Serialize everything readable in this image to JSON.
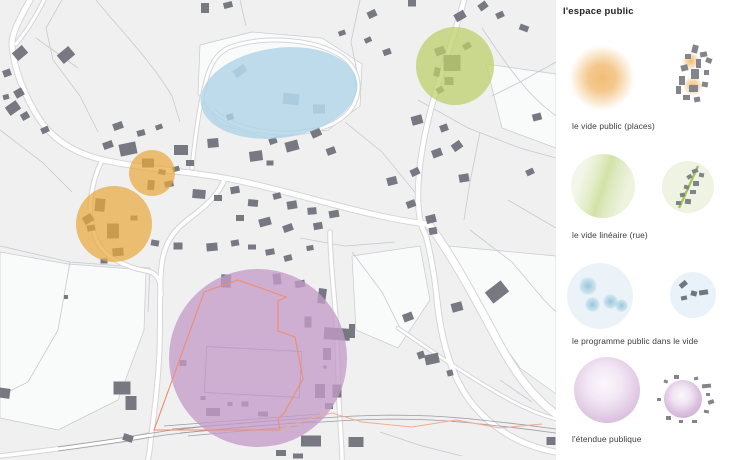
{
  "title": "l'espace public",
  "legend": {
    "items": [
      {
        "label": "le vide public (places)",
        "color": "#eeb05a",
        "symbol": "orange-glow-blob"
      },
      {
        "label": "le vide linéaire (rue)",
        "color": "#c6d77f",
        "symbol": "green-linear-gradient-circle"
      },
      {
        "label": "le programme public dans le vide",
        "color": "#bfdcec",
        "symbol": "blue-circle-with-dots"
      },
      {
        "label": "l'étendue publique",
        "color": "#cdaad2",
        "symbol": "purple-sphere-circle"
      }
    ]
  },
  "map": {
    "background": "#f0f0f1",
    "field_color": "#fafbfb",
    "parcel_line_color": "#c9c9cf",
    "road_casing": "#d5d5d9",
    "road_color": "#ffffff",
    "railway_color": "#9b9ba3",
    "building_color": "#787882",
    "building_light": "#9aadbd",
    "boundary_color": "#ef8e70",
    "boundary_ext_color": "#f2ab8e",
    "overlays": [
      {
        "shape": "ellipse",
        "cx": 279,
        "cy": 93,
        "rx": 79,
        "ry": 45,
        "rot": -8,
        "fill": "#aed3e6",
        "opacity": 0.8,
        "name": "blue-ellipse-overlay"
      },
      {
        "shape": "circle",
        "cx": 455,
        "cy": 66,
        "rx": 39,
        "ry": 39,
        "rot": 0,
        "fill": "#bcd06a",
        "opacity": 0.75,
        "name": "green-circle-overlay"
      },
      {
        "shape": "circle",
        "cx": 152,
        "cy": 173,
        "rx": 23,
        "ry": 23,
        "rot": 0,
        "fill": "#e8a93f",
        "opacity": 0.72,
        "name": "orange-small-overlay"
      },
      {
        "shape": "circle",
        "cx": 114,
        "cy": 224,
        "rx": 38,
        "ry": 38,
        "rot": 0,
        "fill": "#e8a93f",
        "opacity": 0.72,
        "name": "orange-large-overlay"
      },
      {
        "shape": "circle",
        "cx": 258,
        "cy": 358,
        "rx": 89,
        "ry": 89,
        "rot": 0,
        "fill": "#c49bc8",
        "opacity": 0.78,
        "name": "purple-circle-overlay"
      }
    ],
    "fields": [
      "M 200,45 L 252,32 L 322,38 L 362,64 L 360,106 L 328,130 L 268,138 L 220,124 L 198,94 Z",
      "M 448,246 L 556,256 L 556,394 L 520,368 L 472,300 Z",
      "M 0,252 L 68,264 L 146,270 L 144,330 L 118,400 L 58,430 L 0,418 Z",
      "M 352,256 L 420,246 L 430,300 L 398,348 L 356,330 Z",
      "M 486,64 L 556,74 L 556,148 L 502,128 Z"
    ],
    "parcels": [
      "M 62,0 L 46,28 L 53,60 L 80,96 L 98,132",
      "M 96,0 C 122,32 152,62 172,96 L 180,122",
      "M 360,0 L 351,42 L 359,82",
      "M 482,28 C 502,58 522,88 546,108 L 556,116",
      "M 418,100 L 468,128 L 520,148 L 556,158",
      "M 0,130 L 42,162 L 72,192",
      "M 0,246 L 70,262 L 150,268",
      "M 70,262 L 58,330 L 28,382 L 0,396",
      "M 150,268 L 148,312",
      "M 345,122 L 382,152 L 418,196",
      "M 470,230 L 512,262 L 544,300 L 556,312",
      "M 352,252 L 382,292 L 402,332",
      "M 480,132 L 470,182 L 464,220",
      "M 556,62 L 520,82 L 492,96",
      "M 380,432 L 422,446 L 462,456",
      "M 500,380 L 532,402",
      "M 240,0 L 246,26",
      "M 300,238 L 345,246 L 395,242",
      "M 36,38 L 78,68",
      "M 508,200 L 556,228"
    ],
    "roads": [
      {
        "d": "M 30,0 C 20,18 11,34 12,46 C 14,68 24,96 40,120 C 55,142 78,155 108,161 C 150,170 190,171 235,180 C 285,190 340,208 390,218 C 405,221 418,223 428,224",
        "w": 5
      },
      {
        "d": "M 464,0 C 455,35 441,72 432,105 C 424,135 418,168 418,196 C 418,215 421,227 426,236 C 431,256 435,278 437,300",
        "w": 4.5
      },
      {
        "d": "M 428,224 C 448,248 476,300 500,345 C 517,376 536,400 556,414",
        "w": 7
      },
      {
        "d": "M 437,300 C 441,340 452,380 474,406 C 496,432 526,447 556,452",
        "w": 5
      },
      {
        "d": "M 225,178 C 218,198 200,210 185,222 C 170,234 163,248 161,270 C 159,300 161,330 159,360 C 157,395 153,420 151,438 C 150,448 149,455 148,460",
        "w": 4
      },
      {
        "d": "M 102,160 C 90,185 86,214 96,239 C 103,256 124,267 147,271 C 158,273 161,282 161,295",
        "w": 3.5
      },
      {
        "d": "M 330,232 C 330,260 334,290 336,320 C 338,355 338,390 340,420 C 341,438 342,450 342,460",
        "w": 3.5
      },
      {
        "d": "M 192,168 C 195,138 199,108 205,85 C 209,66 216,54 228,48 C 258,36 305,38 332,51 C 355,61 362,80 356,99 C 349,121 321,132 291,133 C 262,134 232,127 215,112",
        "w": 3
      },
      {
        "d": "M 0,456 C 35,452 80,446 122,440 C 136,438 145,436 152,434",
        "w": 3.5
      },
      {
        "d": "M 398,328 C 430,350 470,378 510,400 C 528,410 545,416 556,419",
        "w": 2.5
      },
      {
        "d": "M 44,0 C 36,16 26,32 16,44",
        "w": 3
      }
    ],
    "railway": [
      "M 58,447 C 110,440 140,435 165,431 C 215,425 270,420 322,418 C 390,413 440,415 490,421 C 520,424 540,427 556,429",
      "M 58,451 C 110,444 140,439 165,435 C 215,429 270,424 322,422 C 390,417 440,419 490,425 C 520,428 540,431 556,433",
      "M 172,429 L 320,417",
      "M 180,433 L 316,421",
      "M 188,436 L 298,426",
      "M 164,426 L 320,414"
    ],
    "buildings": [
      [
        20,
        53,
        13,
        10,
        -40
      ],
      [
        7,
        73,
        8,
        7,
        -20
      ],
      [
        19,
        93,
        9,
        8,
        -30
      ],
      [
        6,
        97,
        6,
        5,
        -15
      ],
      [
        13,
        108,
        13,
        10,
        -35
      ],
      [
        25,
        116,
        8,
        7,
        -30
      ],
      [
        66,
        55,
        15,
        11,
        -40
      ],
      [
        45,
        130,
        8,
        6,
        -25
      ],
      [
        108,
        145,
        10,
        7,
        -20
      ],
      [
        128,
        149,
        17,
        12,
        -12
      ],
      [
        118,
        126,
        10,
        7,
        -20
      ],
      [
        141,
        133,
        8,
        6,
        -15
      ],
      [
        159,
        127,
        7,
        5,
        -20
      ],
      [
        176,
        169,
        7,
        5,
        -15
      ],
      [
        148,
        163,
        12,
        9,
        0
      ],
      [
        162,
        172,
        7,
        5,
        10
      ],
      [
        169,
        184,
        9,
        6,
        -10
      ],
      [
        151,
        185,
        7,
        10,
        5
      ],
      [
        88,
        219,
        10,
        8,
        -30
      ],
      [
        100,
        205,
        10,
        13,
        5
      ],
      [
        91,
        228,
        8,
        6,
        -10
      ],
      [
        113,
        231,
        12,
        15,
        0
      ],
      [
        134,
        218,
        7,
        5,
        0
      ],
      [
        118,
        252,
        11,
        8,
        -5
      ],
      [
        104,
        261,
        7,
        5,
        0
      ],
      [
        181,
        150,
        14,
        10,
        0
      ],
      [
        190,
        163,
        8,
        6,
        0
      ],
      [
        213,
        143,
        11,
        9,
        -5
      ],
      [
        230,
        117,
        7,
        6,
        -15
      ],
      [
        256,
        156,
        13,
        10,
        -8
      ],
      [
        270,
        163,
        7,
        5,
        0
      ],
      [
        273,
        141,
        8,
        6,
        -20
      ],
      [
        292,
        146,
        13,
        10,
        -15
      ],
      [
        316,
        133,
        10,
        8,
        -25
      ],
      [
        331,
        151,
        9,
        7,
        -20
      ],
      [
        199,
        194,
        13,
        9,
        5
      ],
      [
        218,
        198,
        8,
        6,
        0
      ],
      [
        235,
        190,
        9,
        7,
        -10
      ],
      [
        253,
        203,
        10,
        7,
        5
      ],
      [
        277,
        196,
        8,
        6,
        -15
      ],
      [
        292,
        205,
        10,
        8,
        -10
      ],
      [
        312,
        211,
        9,
        7,
        -5
      ],
      [
        334,
        214,
        10,
        7,
        -10
      ],
      [
        265,
        222,
        12,
        8,
        -15
      ],
      [
        288,
        228,
        10,
        7,
        -20
      ],
      [
        240,
        218,
        8,
        6,
        0
      ],
      [
        318,
        226,
        9,
        7,
        -10
      ],
      [
        240,
        71,
        13,
        8,
        -35,
        "l"
      ],
      [
        291,
        99,
        16,
        11,
        5,
        "l"
      ],
      [
        319,
        109,
        12,
        9,
        0,
        "l"
      ],
      [
        205,
        8,
        8,
        10,
        0
      ],
      [
        228,
        5,
        9,
        6,
        -15
      ],
      [
        372,
        14,
        9,
        7,
        -25
      ],
      [
        342,
        33,
        7,
        5,
        -20
      ],
      [
        412,
        3,
        8,
        7,
        0
      ],
      [
        460,
        16,
        11,
        8,
        -30
      ],
      [
        483,
        6,
        9,
        7,
        -35
      ],
      [
        500,
        15,
        8,
        6,
        -25
      ],
      [
        524,
        28,
        9,
        6,
        20
      ],
      [
        387,
        52,
        8,
        6,
        -20
      ],
      [
        368,
        40,
        7,
        5,
        -25
      ],
      [
        452,
        63,
        17,
        16,
        0
      ],
      [
        440,
        51,
        10,
        8,
        -20
      ],
      [
        449,
        81,
        9,
        8,
        0
      ],
      [
        467,
        46,
        8,
        6,
        -30
      ],
      [
        437,
        72,
        6,
        9,
        10
      ],
      [
        440,
        90,
        7,
        6,
        -30
      ],
      [
        417,
        120,
        11,
        9,
        -15
      ],
      [
        444,
        128,
        8,
        7,
        -20
      ],
      [
        457,
        146,
        10,
        8,
        -35
      ],
      [
        437,
        153,
        10,
        8,
        -20
      ],
      [
        415,
        172,
        9,
        7,
        -25
      ],
      [
        392,
        181,
        10,
        8,
        -15
      ],
      [
        411,
        204,
        9,
        7,
        -20
      ],
      [
        431,
        219,
        10,
        8,
        -15
      ],
      [
        464,
        178,
        10,
        8,
        -10
      ],
      [
        537,
        117,
        9,
        7,
        -15
      ],
      [
        530,
        172,
        8,
        6,
        -25
      ],
      [
        155,
        243,
        8,
        6,
        10
      ],
      [
        178,
        246,
        9,
        7,
        0
      ],
      [
        212,
        247,
        11,
        8,
        -5
      ],
      [
        235,
        243,
        8,
        6,
        -10
      ],
      [
        252,
        247,
        8,
        5,
        0
      ],
      [
        270,
        252,
        9,
        6,
        -10
      ],
      [
        288,
        258,
        8,
        6,
        -15
      ],
      [
        310,
        248,
        7,
        5,
        -10
      ],
      [
        226,
        281,
        10,
        13,
        3
      ],
      [
        277,
        279,
        8,
        11,
        -5
      ],
      [
        300,
        284,
        10,
        7,
        -10
      ],
      [
        322,
        296,
        8,
        15,
        8
      ],
      [
        308,
        322,
        7,
        11,
        0
      ],
      [
        337,
        334,
        26,
        12,
        4
      ],
      [
        352,
        331,
        6,
        14,
        0
      ],
      [
        327,
        354,
        8,
        12,
        0
      ],
      [
        325,
        367,
        3,
        3,
        0
      ],
      [
        337,
        391,
        9,
        13,
        0
      ],
      [
        183,
        363,
        7,
        6,
        0
      ],
      [
        213,
        412,
        14,
        8,
        0
      ],
      [
        245,
        404,
        7,
        5,
        0
      ],
      [
        263,
        414,
        10,
        5,
        0
      ],
      [
        203,
        398,
        5,
        4,
        0
      ],
      [
        230,
        404,
        5,
        4,
        0
      ],
      [
        3,
        393,
        14,
        10,
        8
      ],
      [
        66,
        297,
        4,
        4,
        0
      ],
      [
        122,
        388,
        17,
        13,
        0
      ],
      [
        131,
        403,
        11,
        14,
        0
      ],
      [
        128,
        438,
        10,
        7,
        18
      ],
      [
        320,
        391,
        10,
        14,
        0
      ],
      [
        329,
        406,
        8,
        6,
        0
      ],
      [
        311,
        441,
        20,
        11,
        0
      ],
      [
        281,
        453,
        10,
        6,
        0
      ],
      [
        356,
        442,
        15,
        10,
        0
      ],
      [
        298,
        456,
        10,
        5,
        0
      ],
      [
        457,
        307,
        11,
        9,
        -15
      ],
      [
        497,
        292,
        20,
        14,
        -38
      ],
      [
        408,
        317,
        10,
        8,
        -20
      ],
      [
        421,
        355,
        7,
        7,
        -20
      ],
      [
        432,
        359,
        14,
        10,
        -12
      ],
      [
        450,
        373,
        6,
        6,
        -15
      ],
      [
        433,
        231,
        8,
        7,
        -10
      ],
      [
        551,
        441,
        9,
        8,
        0
      ]
    ],
    "outline_building": {
      "cx": 253,
      "cy": 372,
      "w": 95,
      "h": 46,
      "rot": 3,
      "stroke": "#ad97b3"
    },
    "boundary": "M 238,280 L 286,297 L 278,301 L 278,331 L 295,337 L 303,379 L 284,413 L 278,419 L 280,430 L 154,430 L 202,298 L 204,292 Z",
    "boundary_ext": "M 280,430 L 308,419 L 332,413 L 362,422 L 412,427 L 456,420 L 500,428 L 542,424"
  }
}
